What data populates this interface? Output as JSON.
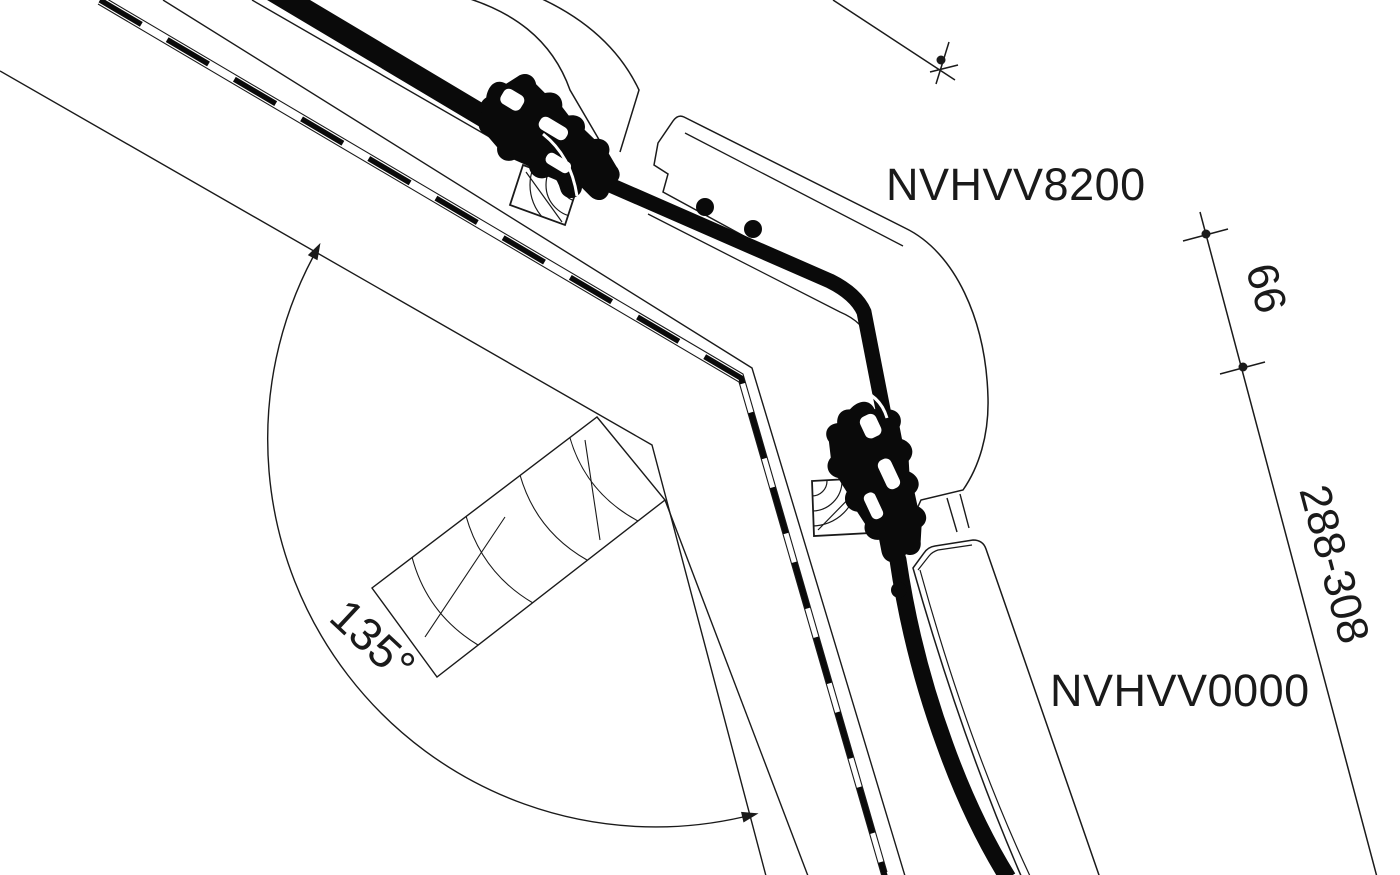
{
  "diagram": {
    "type": "technical-cross-section",
    "labels": {
      "upper_profile": "NVHVV8200",
      "lower_profile": "NVHVV0000"
    },
    "dimensions": {
      "spacing": "66",
      "range": "288-308",
      "angle": "135°"
    },
    "colors": {
      "background": "#ffffff",
      "line": "#1a1a1a",
      "profile_fill": "#0a0a0a"
    }
  }
}
